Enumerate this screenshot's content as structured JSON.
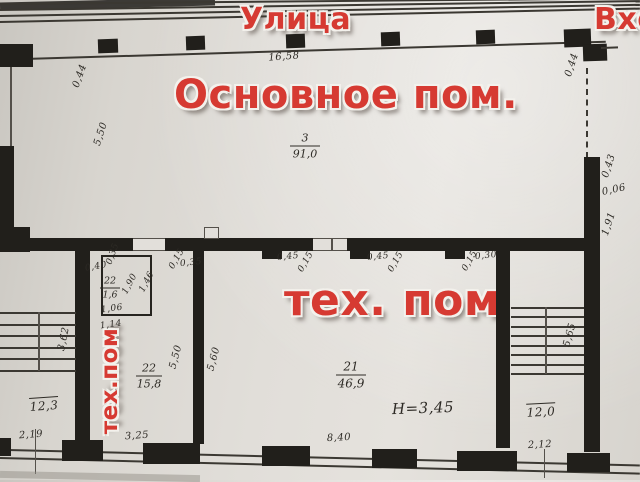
{
  "labels": {
    "street": "Улица",
    "entrance": "Вход",
    "main_room": "Основное пом.",
    "tech_room": "тех. пом",
    "tech_room_vertical": "тех.пом",
    "ceiling_height": "H=3,45"
  },
  "rooms": {
    "main": {
      "number": "3",
      "area": "91,0"
    },
    "tech_big": {
      "number": "21",
      "area": "46,9"
    },
    "tech_small": {
      "number": "22",
      "area": "15,8"
    },
    "closet": {
      "number": "22",
      "area": "1,6"
    },
    "stair_left": {
      "area": "12,3"
    },
    "stair_right": {
      "area": "12,0"
    }
  },
  "dims": {
    "top_width": "16,58",
    "left_corner": "0,44",
    "left_height": "5,50",
    "right_corner": "0,44",
    "right_d1": "0,43",
    "right_d2": "0,06",
    "right_d3": "1,91",
    "wall_g1a": "0,15",
    "wall_g1b": "0,35",
    "wall_g2a": "0,45",
    "wall_g2b": "0,15",
    "wall_g3a": "0,45",
    "wall_g3b": "0,15",
    "wall_g4a": "0,15",
    "wall_g4b": "0,30",
    "closet_a": "0,40",
    "closet_b": "0,35",
    "closet_c": "1,06",
    "closet_d": "1,14",
    "closet_e": "1,90",
    "closet_f": "1,46",
    "room22_width": "5,50",
    "room22_bottom": "3,25",
    "room21_width": "5,60",
    "room21_bottom": "8,40",
    "stair_left_height": "3,62",
    "stair_left_bottom": "2,19",
    "stair_right_height": "5,65",
    "stair_right_bottom": "2,12"
  },
  "colors": {
    "red": "#d63a32",
    "ink": "#211f1b",
    "paper": "#e2dfda"
  }
}
